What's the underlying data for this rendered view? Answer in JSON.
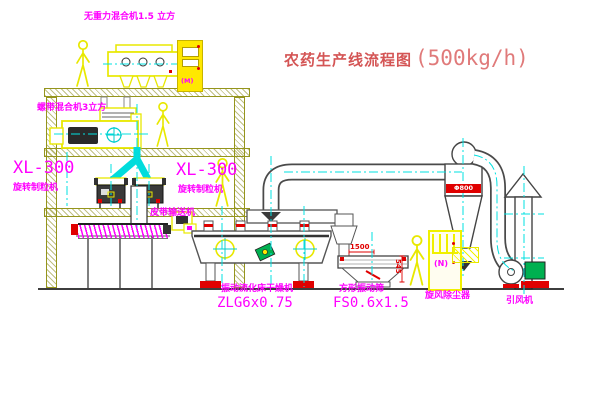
{
  "title": {
    "name": "农药生产线流程图",
    "capacity": "(500kg/h)"
  },
  "colors": {
    "line_yellow": "#e8e800",
    "centerline_cyan": "#00e1e1",
    "label_magenta": "#ff00ff",
    "accent_red": "#e00000",
    "structure_olive": "#95951c",
    "motor_green": "#00b050",
    "title_red": "#d45555"
  },
  "equipment": {
    "top_mixer": {
      "label": "无重力混合机1.5 立方"
    },
    "mid_mixer": {
      "label": "螺带混合机3立方"
    },
    "granulator_left": {
      "model": "XL-300",
      "label": "旋转制粒机"
    },
    "granulator_right": {
      "model": "XL-300",
      "label": "旋转制粒机"
    },
    "belt_conveyor": {
      "label": "皮带输送机"
    },
    "fluid_bed_dryer": {
      "label": "振动流化床干燥机",
      "model": "ZLG6x0.75"
    },
    "vibrating_screen": {
      "label": "方形振动筛",
      "model": "FS0.6x1.5",
      "dim_width": "1500",
      "dim_height": "545"
    },
    "cyclone": {
      "label": "旋风除尘器",
      "dim": "Φ800"
    },
    "fan": {
      "label": "引风机"
    },
    "control_cabinet_top": {
      "mark": "(M)"
    },
    "control_cabinet_right": {
      "mark": "(N)"
    }
  }
}
